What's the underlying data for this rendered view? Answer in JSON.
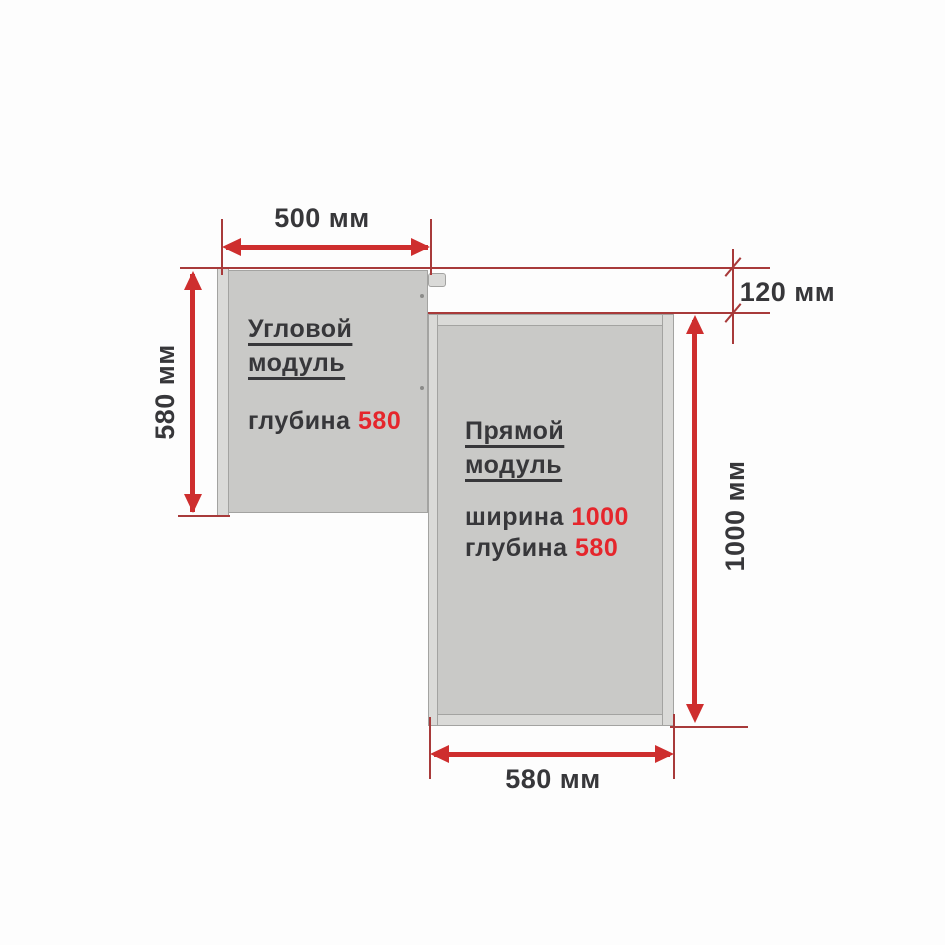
{
  "diagram_title": "Модули кухни — схема размеров",
  "colors": {
    "background": "#fdfdfd",
    "module_fill": "#c9c9c7",
    "module_edge": "#dadad8",
    "module_border": "#a3a3a1",
    "arrow_red": "#ce2e2e",
    "thin_line_red": "#a83a3a",
    "text_dark": "#37373a",
    "value_red": "#e5262c"
  },
  "corner_module": {
    "title_line1": "Угловой",
    "title_line2": "модуль",
    "specs": [
      {
        "label": "глубина",
        "value": "580"
      }
    ]
  },
  "straight_module": {
    "title_line1": "Прямой",
    "title_line2": "модуль",
    "specs": [
      {
        "label": "ширина",
        "value": "1000"
      },
      {
        "label": "глубина",
        "value": "580"
      }
    ]
  },
  "dimensions": {
    "top_width": "500 мм",
    "left_depth": "580 мм",
    "right_offset": "120 мм",
    "right_height": "1000 мм",
    "bottom_width": "580 мм"
  }
}
